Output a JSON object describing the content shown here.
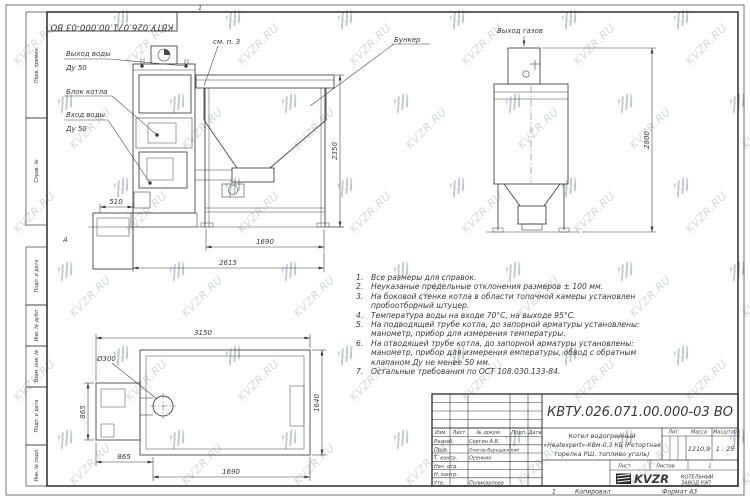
{
  "doc": {
    "number_top": "КВТУ.026.071.00.000-03 ВО",
    "top_mark": "1"
  },
  "zone_letter": "А",
  "watermark": {
    "text": "KVZR.RU"
  },
  "labels": {
    "see_note": "см. п. 3",
    "bunker": "Бункер",
    "gas_out": "Выход газов",
    "water_out_1": "Выход воды",
    "water_out_2": "Ду 50",
    "boiler_block": "Блок котла",
    "water_in_1": "Вход воды",
    "water_in_2": "Ду 50"
  },
  "dims": {
    "front_height": "2350",
    "front_feet": "1690",
    "front_total": "2615",
    "front_pit": "510",
    "side_height": "2800",
    "plan_total": "3150",
    "plan_depth": "1640",
    "plan_left": "865",
    "plan_bottom_left": "865",
    "plan_bottom": "1690",
    "plan_dia": "Ø300"
  },
  "notes": [
    {
      "n": "1.",
      "text": "Все размеры для справок."
    },
    {
      "n": "2.",
      "text": "Неуказаные предельные отклонения размеров ± 100 мм."
    },
    {
      "n": "3.",
      "text": "На боковой стенке котла в области топочной камеры установлен пробоотборный штуцер."
    },
    {
      "n": "4.",
      "text": "Температура воды на входе 70°С, на выходе 95°С."
    },
    {
      "n": "5.",
      "text": "На подводящей трубе котла, до запорной арматуры установлены: манометр, прибор для измерения температуры."
    },
    {
      "n": "6.",
      "text": "На отводящей трубе котла, до запорной арматуры установлены: манометр, прибор для измерения емпературы, обвод с обратным клапаном Ду не менее 50 мм."
    },
    {
      "n": "7.",
      "text": "Остальные требования по ОСТ 108.030.133-84."
    }
  ],
  "margin_labels": [
    "Перв. примен.",
    "Справ. №",
    "Подп. и дата",
    "Инв. № дубл.",
    "Взам. инв. №",
    "Подп. и дата",
    "Инв. № подл."
  ],
  "stamp": {
    "number": "КВТУ.026.071.00.000-03 ВО",
    "title_line1": "Котел водогрейный",
    "title_line2": "«Heatexpert»-КВм-0,3 КБ (Ретортная",
    "title_line3": "горелка РШ, топливо уголь)",
    "headers": {
      "izm": "Изм.",
      "list": "Лист",
      "doc": "№ докум.",
      "podp": "Подп.",
      "data": "Дата",
      "lit": "Лит.",
      "massa": "Масса",
      "masshtab": "Масштаб",
      "list2": "Лист",
      "listov": "Листов"
    },
    "mass": "1210,9",
    "scale": "1 : 25",
    "listov_value": "1",
    "rows": [
      {
        "role": "Разраб.",
        "name": "Сергин А.В."
      },
      {
        "role": "Пров.",
        "name": "Онегов-Верещинский"
      },
      {
        "role": "Т. контр.",
        "name": "Осенкин"
      },
      {
        "role": "Нач. отд.",
        "name": ""
      },
      {
        "role": "Н. контр.",
        "name": ""
      },
      {
        "role": "Утв.",
        "name": "Поликарпова"
      }
    ],
    "company": {
      "brand": "KVZR",
      "line1": "КОТЕЛЬНЫЙ",
      "line2": "ЗАВОД РЭП"
    }
  },
  "footer": {
    "copy_num": "1",
    "copied": "Копировал",
    "format": "Формат А3"
  }
}
